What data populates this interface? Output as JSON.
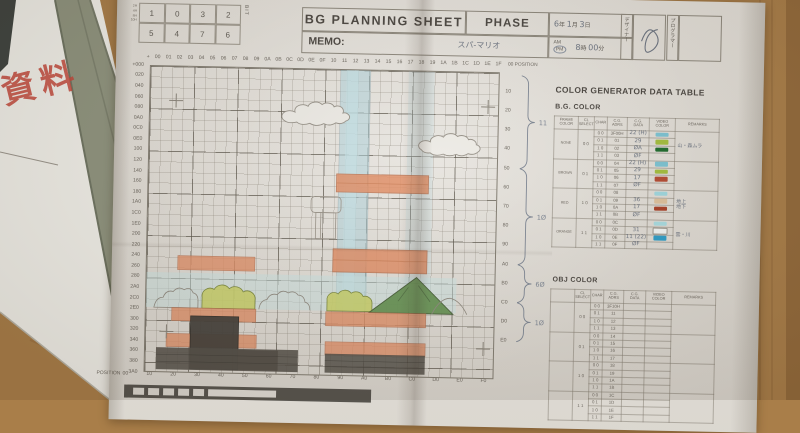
{
  "photo": {
    "desk_color": "#a97e49",
    "folder_color": "#8f947f",
    "under_paper_color": "#f1f0ea",
    "stamp_text": "資料",
    "stamp_color": "#c4483b"
  },
  "header": {
    "title": "BG PLANNING SHEET",
    "phase_label": "PHASE",
    "memo_label": "MEMO:",
    "memo_value": "スパ-マリオ",
    "bit_table": {
      "row1": [
        "1",
        "0",
        "3",
        "2"
      ],
      "row2": [
        "5",
        "4",
        "7",
        "6"
      ],
      "side_labels": [
        "2H",
        "4H",
        "8H",
        "10H"
      ],
      "bit_label": "BIT"
    },
    "date": {
      "year": "6",
      "year_label": "年",
      "month": "1",
      "month_label": "月",
      "day": "3",
      "day_label": "日"
    },
    "time": {
      "am": "AM",
      "pm": "PM",
      "hour": "8",
      "hour_label": "時",
      "minute": "00",
      "minute_label": "分"
    },
    "designer_label": "デザイナー",
    "programmer_label": "プログラマー"
  },
  "grid": {
    "col_prefix": "+",
    "col_labels": [
      "00",
      "01",
      "02",
      "03",
      "04",
      "05",
      "06",
      "07",
      "08",
      "09",
      "0A",
      "0B",
      "0C",
      "0D",
      "0E",
      "0F",
      "10",
      "11",
      "12",
      "13",
      "14",
      "15",
      "16",
      "17",
      "18",
      "19",
      "1A",
      "1B",
      "1C",
      "1D",
      "1E",
      "1F"
    ],
    "row_labels": [
      "+000",
      "020",
      "040",
      "060",
      "080",
      "0A0",
      "0C0",
      "0E0",
      "100",
      "120",
      "140",
      "160",
      "180",
      "1A0",
      "1C0",
      "1E0",
      "200",
      "220",
      "240",
      "260",
      "280",
      "2A0",
      "2C0",
      "2E0",
      "300",
      "320",
      "340",
      "360",
      "380",
      "3A0"
    ],
    "right_labels": [
      "10",
      "20",
      "30",
      "40",
      "50",
      "60",
      "70",
      "80",
      "90",
      "A0",
      "B0",
      "C0",
      "D0",
      "E0"
    ],
    "position_top": "00 POSITION",
    "position_bottom_label": "POSITION",
    "bottom_positions": [
      "00",
      "10",
      "20",
      "30",
      "40",
      "50",
      "60",
      "70",
      "80",
      "90",
      "A0",
      "B0",
      "C0",
      "D0",
      "E0",
      "F0"
    ],
    "annotations": [
      {
        "label": "11",
        "from": 3,
        "to": 96
      },
      {
        "label": "1Ø",
        "from": 96,
        "to": 192
      },
      {
        "label": "6Ø",
        "from": 192,
        "to": 230
      },
      {
        "label": "1Ø",
        "from": 230,
        "to": 269
      }
    ]
  },
  "color_table": {
    "title": "COLOR GENERATOR DATA TABLE",
    "bg_section": "B.G. COLOR",
    "obj_section": "OBJ COLOR",
    "headers": [
      "FRAME\nCOLOR",
      "CL\nSELECT",
      "CHAR",
      "C.G.\nADRS",
      "C.G.\nDATA",
      "VIDEO\nCOLOR",
      "REMARKS"
    ],
    "bg_groups": [
      {
        "frame": "NONE",
        "cl": "0 0",
        "remark": "山・森ムラ",
        "rows": [
          {
            "char": "0 0",
            "adrs": "3F00H",
            "data": "22 (H)",
            "color": "#7cc4d4"
          },
          {
            "char": "0 1",
            "adrs": "01",
            "data": "29",
            "color": "#a4bf3e"
          },
          {
            "char": "1 0",
            "adrs": "02",
            "data": "ØA",
            "color": "#1d6b2d"
          },
          {
            "char": "1 1",
            "adrs": "03",
            "data": "ØF",
            "color": ""
          }
        ]
      },
      {
        "frame": "BROWN",
        "cl": "0 1",
        "remark": "",
        "rows": [
          {
            "char": "0 0",
            "adrs": "04",
            "data": "22 (H)",
            "color": "#7cc4d4"
          },
          {
            "char": "0 1",
            "adrs": "05",
            "data": "29",
            "color": "#a4bf3e"
          },
          {
            "char": "1 0",
            "adrs": "06",
            "data": "17",
            "color": "#b44a32"
          },
          {
            "char": "1 1",
            "adrs": "07",
            "data": "ØF",
            "color": ""
          }
        ]
      },
      {
        "frame": "RED",
        "cl": "1 0",
        "remark": "地上\n地下",
        "rows": [
          {
            "char": "0 0",
            "adrs": "08",
            "data": "",
            "color": "#9fd8e0"
          },
          {
            "char": "0 1",
            "adrs": "09",
            "data": "36",
            "color": "#dec29e"
          },
          {
            "char": "1 0",
            "adrs": "0A",
            "data": "17",
            "color": "#a84028"
          },
          {
            "char": "1 1",
            "adrs": "0B",
            "data": "ØF",
            "color": ""
          }
        ]
      },
      {
        "frame": "ORANGE",
        "cl": "1 1",
        "remark": "雲・川",
        "rows": [
          {
            "char": "0 0",
            "adrs": "0C",
            "data": "",
            "color": "#a8dce2"
          },
          {
            "char": "0 1",
            "adrs": "0D",
            "data": "31",
            "color": "#f2f5f3",
            "outline": true
          },
          {
            "char": "1 0",
            "adrs": "0E",
            "data": "11 (22)",
            "color": "#2e9ec8"
          },
          {
            "char": "1 1",
            "adrs": "0F",
            "data": "ØF",
            "color": ""
          }
        ]
      }
    ],
    "obj_groups": [
      {
        "frame": "",
        "cl": "0 0",
        "remark": "",
        "rows": [
          {
            "char": "0 0",
            "adrs": "3F10H"
          },
          {
            "char": "0 1",
            "adrs": "11"
          },
          {
            "char": "1 0",
            "adrs": "12"
          },
          {
            "char": "1 1",
            "adrs": "13"
          }
        ]
      },
      {
        "frame": "",
        "cl": "0 1",
        "remark": "",
        "rows": [
          {
            "char": "0 0",
            "adrs": "14"
          },
          {
            "char": "0 1",
            "adrs": "15"
          },
          {
            "char": "1 0",
            "adrs": "16"
          },
          {
            "char": "1 1",
            "adrs": "17"
          }
        ]
      },
      {
        "frame": "",
        "cl": "1 0",
        "remark": "",
        "rows": [
          {
            "char": "0 0",
            "adrs": "18"
          },
          {
            "char": "0 1",
            "adrs": "19"
          },
          {
            "char": "1 0",
            "adrs": "1A"
          },
          {
            "char": "1 1",
            "adrs": "1B"
          }
        ]
      },
      {
        "frame": "",
        "cl": "1 1",
        "remark": "",
        "rows": [
          {
            "char": "0 0",
            "adrs": "1C"
          },
          {
            "char": "0 1",
            "adrs": "1D"
          },
          {
            "char": "1 0",
            "adrs": "1E"
          },
          {
            "char": "1 1",
            "adrs": "1F"
          }
        ]
      }
    ]
  }
}
